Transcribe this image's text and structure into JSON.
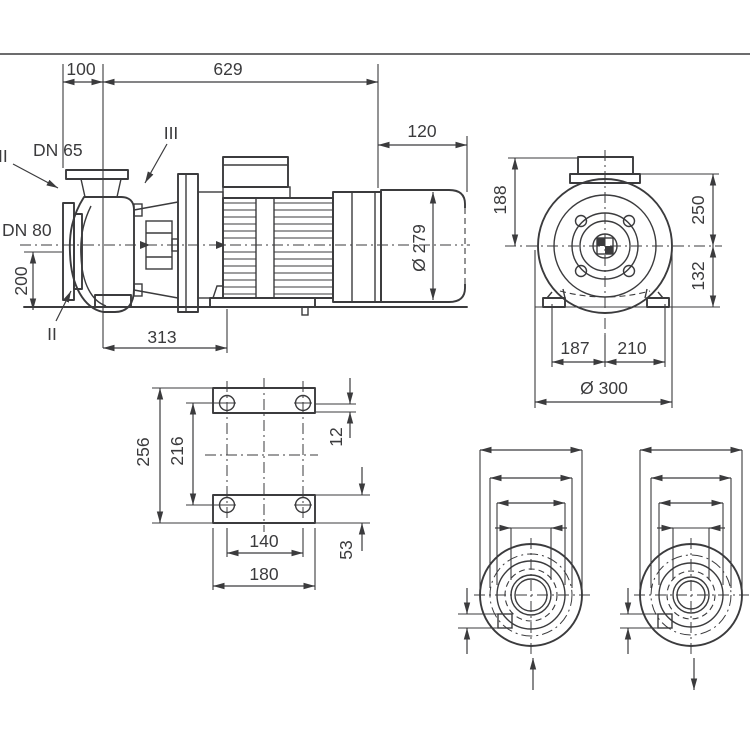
{
  "title": "Pump dimensional drawing",
  "colors": {
    "line": "#3b3b3d",
    "background": "#ffffff"
  },
  "views": {
    "side": {
      "dims": {
        "front_to_axis": "100",
        "total_length": "629",
        "fan_overhang": "120",
        "motor_diameter": "Ø 279",
        "foot_distance": "313",
        "suction_height": "200"
      },
      "labels": {
        "discharge_port": "DN 65",
        "suction_port": "DN 80",
        "section_top": "II",
        "section_bottom": "II",
        "section_three": "III"
      }
    },
    "front": {
      "dims": {
        "box_height": "188",
        "top_to_axis": "250",
        "axis_to_base": "132",
        "axis_to_left": "187",
        "axis_to_right": "210",
        "flange_diameter": "Ø 300"
      }
    },
    "foot": {
      "dims": {
        "outer_length": "256",
        "hole_pitch_long": "216",
        "pad_offset": "12",
        "hole_pitch_wide": "140",
        "pad_width": "180",
        "pad_height": "53"
      }
    },
    "flange_dn1": {
      "outer": "Ø 200",
      "bolt_circle": "Ø 160",
      "face": "Ø 132",
      "nominal": "DN 80",
      "bolt_holes": "8 x Ø19",
      "port": "DN1"
    },
    "flange_dn2": {
      "outer": "Ø 185",
      "bolt_circle": "Ø 145",
      "face": "Ø 118",
      "nominal": "DN 65",
      "bolt_holes": "4 x Ø19",
      "port": "DN2"
    }
  }
}
